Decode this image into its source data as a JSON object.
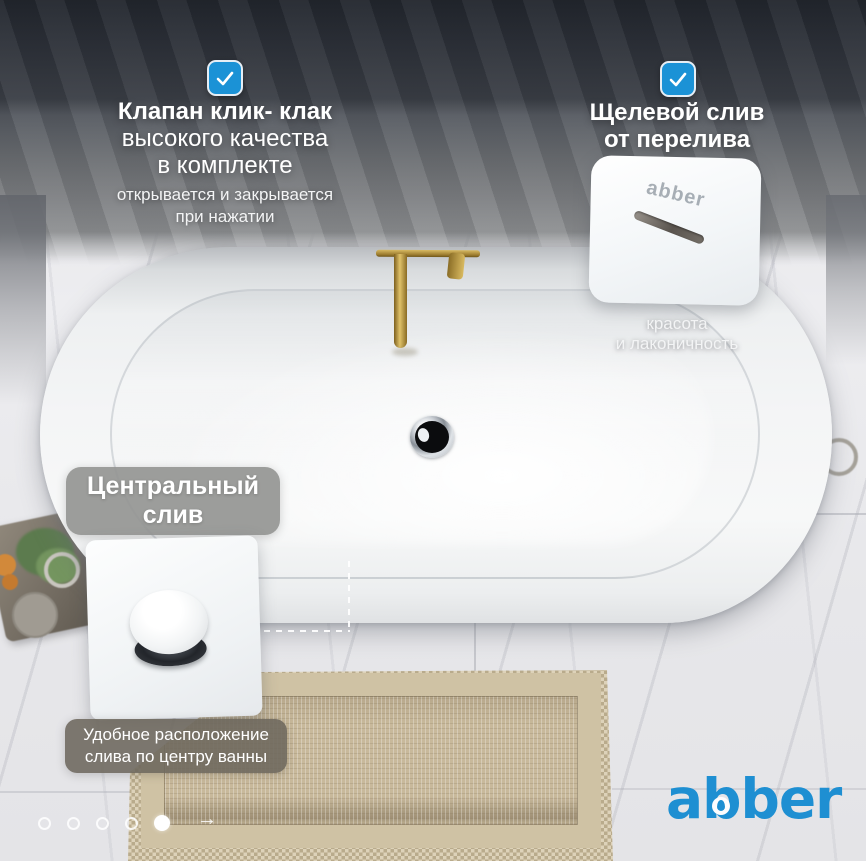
{
  "brand": {
    "logo_text": "abber",
    "logo_color": "#1e8fd2"
  },
  "checkbox_color": "#1b92d6",
  "features": {
    "click_clack": {
      "title_lines": [
        "Клапан клик- клак",
        "высокого качества",
        "в комплекте"
      ],
      "subtitle_lines": [
        "открывается и закрывается",
        "при нажатии"
      ]
    },
    "overflow": {
      "title_lines": [
        "Щелевой слив",
        "от перелива"
      ],
      "card_logo": "abber",
      "caption_lines": [
        "красота",
        "и лаконичность"
      ]
    },
    "central_drain": {
      "label_lines": [
        "Центральный",
        "слив"
      ],
      "caption_lines": [
        "Удобное расположение",
        "слива по центру ванны"
      ]
    }
  },
  "carousel": {
    "dots_total": 5,
    "active_index": 4,
    "next_arrow": "→"
  }
}
